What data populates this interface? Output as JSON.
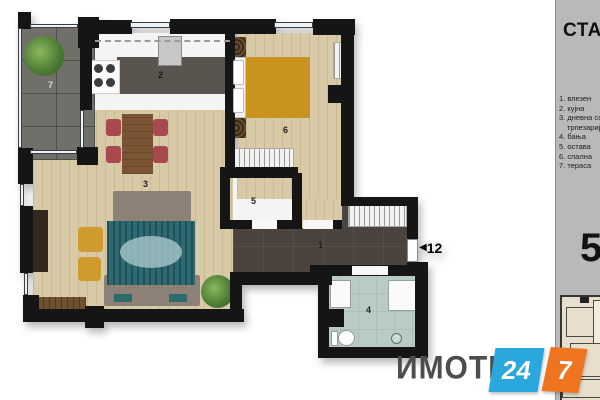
{
  "panel": {
    "title": "СТАН",
    "apartment_number": "5",
    "legend": {
      "lines": [
        "1. влезен",
        "2. кујна",
        "3. дневна со",
        "трпезарија",
        "4. бања",
        "5. остава",
        "6. спална",
        "7. тераса"
      ]
    }
  },
  "plan": {
    "labels": {
      "hallway": "1",
      "kitchen": "2",
      "living_dining": "3",
      "bathroom": "4",
      "storage": "5",
      "bedroom": "6",
      "terrace": "7"
    },
    "entrance_number": "12"
  },
  "logo": {
    "name": "ИМОТИ",
    "badge_blue": "24",
    "badge_orange": "7"
  },
  "colors": {
    "logo_blue": "#2aa7dc",
    "logo_orange": "#ef7420",
    "bed_accent": "#c9931f",
    "chair_red": "#a8494f",
    "rug_teal": "#2e6a72",
    "panel_gray": "#b9b9b9",
    "wall_black": "#151515"
  }
}
